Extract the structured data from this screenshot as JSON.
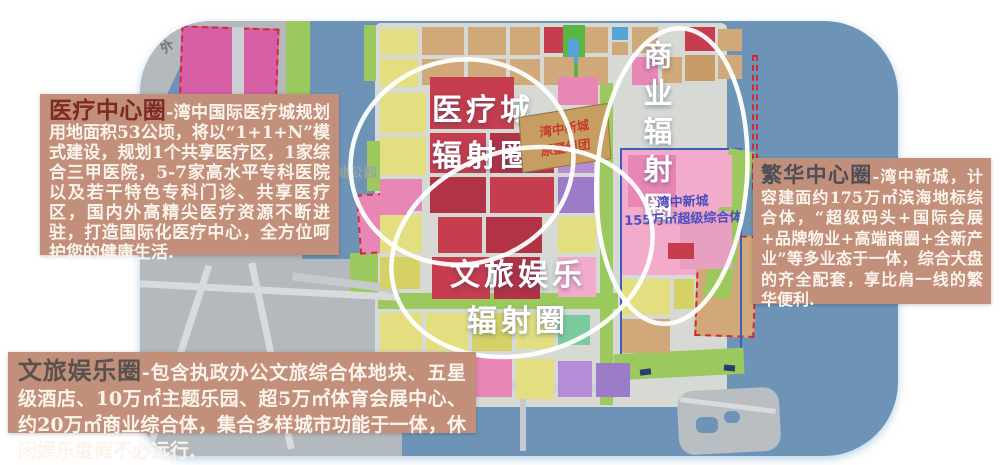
{
  "annotations": {
    "medical_box": {
      "title": "医疗中心圈",
      "body": "-湾中国际医疗城规划用地面积53公顷，将以“1+1+N”模式建设，规划1个共享医疗区，1家综合三甲医院，5-7家高水平专科医院以及若干特色专科门诊、共享医疗区，国内外高精尖医疗资源不断进驻，打造国际化医疗中心，全方位呵护您的健康生活."
    },
    "culture_box": {
      "title": "文旅娱乐圈",
      "body": "-包含执政办公文旅综合体地块、五星级酒店、10万㎡主题乐园、超5万㎡体育会展中心、约20万㎡商业综合体，集合多样城市功能于一体，休闲娱乐度假不必远行."
    },
    "prosperity_box": {
      "title": "繁华中心圈",
      "body": "-湾中新城，计容建面约175万㎡滨海地标综合体，“超级码头+国际会展+品牌物业+高端商圈+全新产业”等多业态于一体，综合大盘的齐全配套，享比肩一线的繁华便利."
    }
  },
  "map": {
    "labels": {
      "medical_circle_line1": "医疗城",
      "medical_circle_line2": "辐射圈",
      "business_circle": "商业辐射圈",
      "culture_circle_line1": "文旅娱乐",
      "culture_circle_line2": "辐射圈",
      "villa_chip_line1": "湾中新城",
      "villa_chip_line2": "原墅组团",
      "complex_line1": "湾中新城",
      "complex_line2": "155万㎡超级综合体",
      "park_partial": "地公园",
      "outer_road": "外"
    },
    "colors": {
      "water": "#6d94b7",
      "land_gray": "#b4b9bd",
      "district_gray": "#d7d9d5",
      "road_gray": "#cfd2d4",
      "dash_red": "#cf2b35",
      "outline_blue": "#3a5fc0",
      "ellipse_white": "#ffffff",
      "box_tan": "#c28f7a"
    },
    "palette": {
      "T": "#d1a87a",
      "T2": "#c79a66",
      "Y": "#e3df80",
      "Y2": "#d6d166",
      "P": "#e886b6",
      "P2": "#f2abcb",
      "PK": "#e8a0c0",
      "M": "#d65fa6",
      "R": "#c63d4e",
      "R2": "#b23246",
      "V": "#b58cd6",
      "V2": "#9c7cc9",
      "G": "#9cc95e",
      "G2": "#5ab643",
      "TL": "#7ccb9e",
      "C": "#54a4d8",
      "GR": "#c6cacc",
      "W": "#6d94b7"
    },
    "regions": [
      {
        "n": "left-land",
        "x": 0,
        "y": 0,
        "w": 162,
        "h": 248,
        "c": "#b4b9bd"
      },
      {
        "n": "bottomleft-land",
        "x": 0,
        "y": 238,
        "w": 262,
        "h": 197,
        "c": "#b4b9bd"
      },
      {
        "n": "river-upper",
        "x": 28,
        "y": 38,
        "w": 16,
        "h": 70,
        "c": "W",
        "rot": 25
      },
      {
        "n": "river-lower",
        "x": -16,
        "y": 98,
        "w": 160,
        "h": 20,
        "c": "W",
        "rot": 15
      },
      {
        "n": "district-land",
        "x": 235,
        "y": 2,
        "w": 352,
        "h": 384,
        "c": "#d7d9d5",
        "r": 6
      },
      {
        "n": "magenta-zone",
        "x": 38,
        "y": 6,
        "w": 94,
        "h": 196,
        "c": "M",
        "rot": 2,
        "dash": true
      },
      {
        "n": "magenta-road",
        "x": 92,
        "y": 6,
        "w": 12,
        "h": 198,
        "c": "#cdd0d3"
      },
      {
        "n": "green-strip-left",
        "x": 146,
        "y": 0,
        "w": 24,
        "h": 216,
        "c": "G"
      },
      {
        "n": "lakeshore-green-1",
        "x": 224,
        "y": 4,
        "w": 12,
        "h": 56,
        "c": "G"
      },
      {
        "n": "lakeshore-green-2",
        "x": 227,
        "y": 120,
        "w": 13,
        "h": 50,
        "c": "G"
      },
      {
        "n": "lakeshore-green-3",
        "x": 210,
        "y": 232,
        "w": 28,
        "h": 44,
        "c": "G"
      },
      {
        "n": "pink-dashed-blob",
        "x": 218,
        "y": 172,
        "w": 46,
        "h": 56,
        "c": "P",
        "rot": -4,
        "dash": true
      },
      {
        "n": "green-canal",
        "x": 460,
        "y": 62,
        "w": 13,
        "h": 322,
        "c": "G"
      },
      {
        "n": "green-cross-band",
        "x": 238,
        "y": 272,
        "w": 240,
        "h": 16,
        "c": "G"
      },
      {
        "n": "newtown-pink-base",
        "x": 482,
        "y": 128,
        "w": 114,
        "h": 126,
        "c": "P2"
      },
      {
        "n": "tan-dashed-zone",
        "x": 556,
        "y": 214,
        "w": 56,
        "h": 98,
        "c": "T",
        "rot": 2,
        "dash": true
      },
      {
        "n": "newtown-blue-outline",
        "x": 480,
        "y": 127,
        "w": 118,
        "h": 222,
        "stroke": "#3a5fc0"
      },
      {
        "n": "shore-green-right",
        "x": 576,
        "y": 128,
        "w": 26,
        "h": 150,
        "c": "G",
        "rot": 10
      },
      {
        "n": "shore-green-bottom",
        "x": 474,
        "y": 330,
        "w": 130,
        "h": 26,
        "c": "G",
        "rot": -3
      },
      {
        "n": "sea-dash-line",
        "x": 612,
        "y": 34,
        "w": 2,
        "h": 130,
        "dash": true
      },
      {
        "n": "shore-road",
        "x": 238,
        "y": 360,
        "w": 250,
        "h": 8,
        "c": "#cfd2d4",
        "rot": 2
      },
      {
        "n": "pier",
        "x": 380,
        "y": 362,
        "w": 6,
        "h": 68,
        "c": "GR"
      },
      {
        "n": "bl-road-1",
        "x": 0,
        "y": 266,
        "w": 258,
        "h": 7,
        "c": "#d8dadc",
        "rot": 3
      },
      {
        "n": "bl-road-2",
        "x": 36,
        "y": 240,
        "w": 7,
        "h": 190,
        "c": "#d8dadc",
        "rot": 18
      },
      {
        "n": "bl-road-3",
        "x": 128,
        "y": 240,
        "w": 7,
        "h": 190,
        "c": "#d8dadc",
        "rot": -12
      },
      {
        "n": "lake-bridge",
        "x": 152,
        "y": 258,
        "w": 108,
        "h": 8,
        "c": "GR",
        "rot": 7
      },
      {
        "n": "island",
        "x": 538,
        "y": 368,
        "w": 102,
        "h": 64,
        "c": "#b9bec2",
        "r": 16,
        "rot": -3
      },
      {
        "n": "island-pond-1",
        "x": 556,
        "y": 396,
        "w": 22,
        "h": 16,
        "c": "W",
        "r": 6
      },
      {
        "n": "island-pond-2",
        "x": 584,
        "y": 390,
        "w": 16,
        "h": 12,
        "c": "W",
        "r": 6
      },
      {
        "n": "island-road",
        "x": 540,
        "y": 382,
        "w": 96,
        "h": 5,
        "c": "#d8dadc",
        "rot": 7
      },
      {
        "n": "boat-1",
        "x": 500,
        "y": 348,
        "w": 11,
        "h": 6,
        "c": "#26406e",
        "rot": -8
      },
      {
        "n": "boat-2",
        "x": 584,
        "y": 344,
        "w": 11,
        "h": 6,
        "c": "#26406e",
        "rot": 5
      }
    ],
    "blocks": [
      [
        240,
        8,
        38,
        26,
        "Y"
      ],
      [
        282,
        6,
        42,
        28,
        "T"
      ],
      [
        328,
        6,
        38,
        28,
        "T"
      ],
      [
        370,
        6,
        30,
        28,
        "T"
      ],
      [
        404,
        6,
        26,
        26,
        "R"
      ],
      [
        434,
        6,
        34,
        26,
        "T"
      ],
      [
        423,
        4,
        22,
        62,
        "G2"
      ],
      [
        428,
        18,
        11,
        24,
        "C"
      ],
      [
        472,
        6,
        16,
        13,
        "C"
      ],
      [
        472,
        21,
        16,
        13,
        "T"
      ],
      [
        492,
        6,
        26,
        26,
        "T"
      ],
      [
        545,
        6,
        30,
        24,
        "R"
      ],
      [
        578,
        8,
        24,
        22,
        "T"
      ],
      [
        240,
        38,
        38,
        28,
        "Y"
      ],
      [
        282,
        38,
        42,
        26,
        "T"
      ],
      [
        328,
        38,
        38,
        26,
        "T"
      ],
      [
        370,
        38,
        30,
        26,
        "T"
      ],
      [
        404,
        36,
        30,
        28,
        "T"
      ],
      [
        438,
        36,
        30,
        28,
        "T"
      ],
      [
        492,
        36,
        26,
        28,
        "P"
      ],
      [
        522,
        36,
        20,
        26,
        "T"
      ],
      [
        545,
        34,
        30,
        26,
        "T2"
      ],
      [
        578,
        34,
        24,
        24,
        "T"
      ],
      [
        240,
        72,
        46,
        40,
        "Y"
      ],
      [
        240,
        116,
        46,
        38,
        "Y"
      ],
      [
        240,
        158,
        42,
        32,
        "P"
      ],
      [
        240,
        194,
        42,
        38,
        "Y"
      ],
      [
        240,
        236,
        40,
        32,
        "Y2"
      ],
      [
        290,
        56,
        84,
        52,
        "R"
      ],
      [
        290,
        112,
        56,
        40,
        "R"
      ],
      [
        350,
        112,
        64,
        40,
        "R2"
      ],
      [
        290,
        156,
        56,
        36,
        "R2"
      ],
      [
        350,
        156,
        64,
        36,
        "R"
      ],
      [
        298,
        196,
        44,
        36,
        "R"
      ],
      [
        346,
        196,
        56,
        36,
        "R2"
      ],
      [
        292,
        236,
        58,
        42,
        "R"
      ],
      [
        354,
        236,
        46,
        42,
        "R2"
      ],
      [
        418,
        56,
        40,
        28,
        "P"
      ],
      [
        418,
        88,
        40,
        22,
        "Y"
      ],
      [
        418,
        114,
        36,
        38,
        "V"
      ],
      [
        418,
        156,
        36,
        36,
        "V2"
      ],
      [
        418,
        196,
        38,
        36,
        "Y"
      ],
      [
        418,
        236,
        38,
        40,
        "P2"
      ],
      [
        488,
        134,
        48,
        52,
        "P"
      ],
      [
        540,
        134,
        52,
        52,
        "P2"
      ],
      [
        488,
        190,
        48,
        58,
        "P2"
      ],
      [
        540,
        190,
        52,
        58,
        "PK"
      ],
      [
        528,
        222,
        26,
        16,
        "R"
      ],
      [
        482,
        258,
        48,
        36,
        "Y"
      ],
      [
        482,
        298,
        48,
        34,
        "T"
      ],
      [
        534,
        258,
        20,
        30,
        "Y2"
      ],
      [
        240,
        292,
        42,
        38,
        "Y"
      ],
      [
        286,
        292,
        42,
        38,
        "Y"
      ],
      [
        332,
        292,
        40,
        38,
        "Y2"
      ],
      [
        376,
        292,
        38,
        36,
        "Y"
      ],
      [
        418,
        294,
        32,
        30,
        "TL"
      ],
      [
        244,
        334,
        42,
        42,
        "Y2"
      ],
      [
        290,
        334,
        42,
        42,
        "Y"
      ],
      [
        336,
        336,
        36,
        40,
        "P"
      ],
      [
        376,
        338,
        38,
        40,
        "Y"
      ],
      [
        418,
        340,
        34,
        36,
        "V"
      ],
      [
        456,
        342,
        34,
        34,
        "V2"
      ]
    ],
    "ellipses": [
      {
        "n": "medical-radiation-circle",
        "cx": 462,
        "cy": 162,
        "rx": 112,
        "ry": 102,
        "rot": -14
      },
      {
        "n": "business-radiation-circle",
        "cx": 672,
        "cy": 176,
        "rx": 75,
        "ry": 148,
        "rot": 4
      },
      {
        "n": "culture-radiation-circle",
        "cx": 522,
        "cy": 252,
        "rx": 133,
        "ry": 102,
        "rot": -17
      }
    ]
  }
}
